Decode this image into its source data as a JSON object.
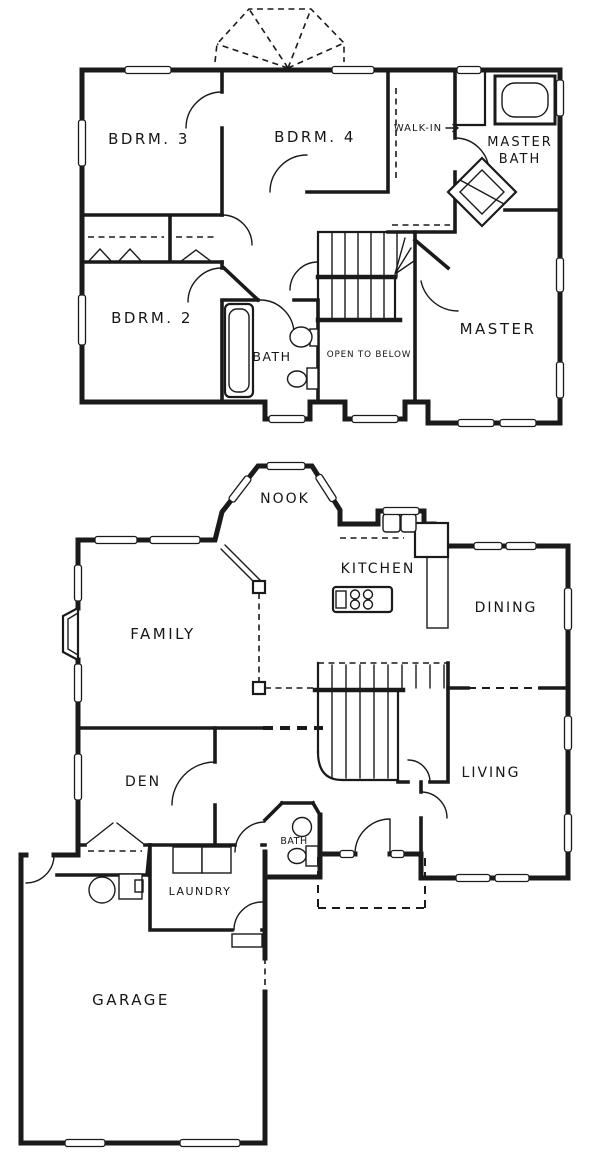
{
  "floorplan": {
    "ink_color": "#1a1a1a",
    "background_color": "#ffffff",
    "upper_floor": {
      "bdrm3": "BDRM. 3",
      "bdrm4": "BDRM. 4",
      "walk_in": "WALK-IN",
      "master_bath_line1": "MASTER",
      "master_bath_line2": "BATH",
      "bdrm2": "BDRM. 2",
      "bath": "BATH",
      "open_to_below": "OPEN TO BELOW",
      "master": "MASTER"
    },
    "lower_floor": {
      "nook": "NOOK",
      "kitchen": "KITCHEN",
      "dining": "DINING",
      "family": "FAMILY",
      "den": "DEN",
      "living": "LIVING",
      "bath": "BATH",
      "laundry": "LAUNDRY",
      "garage": "GARAGE"
    }
  }
}
